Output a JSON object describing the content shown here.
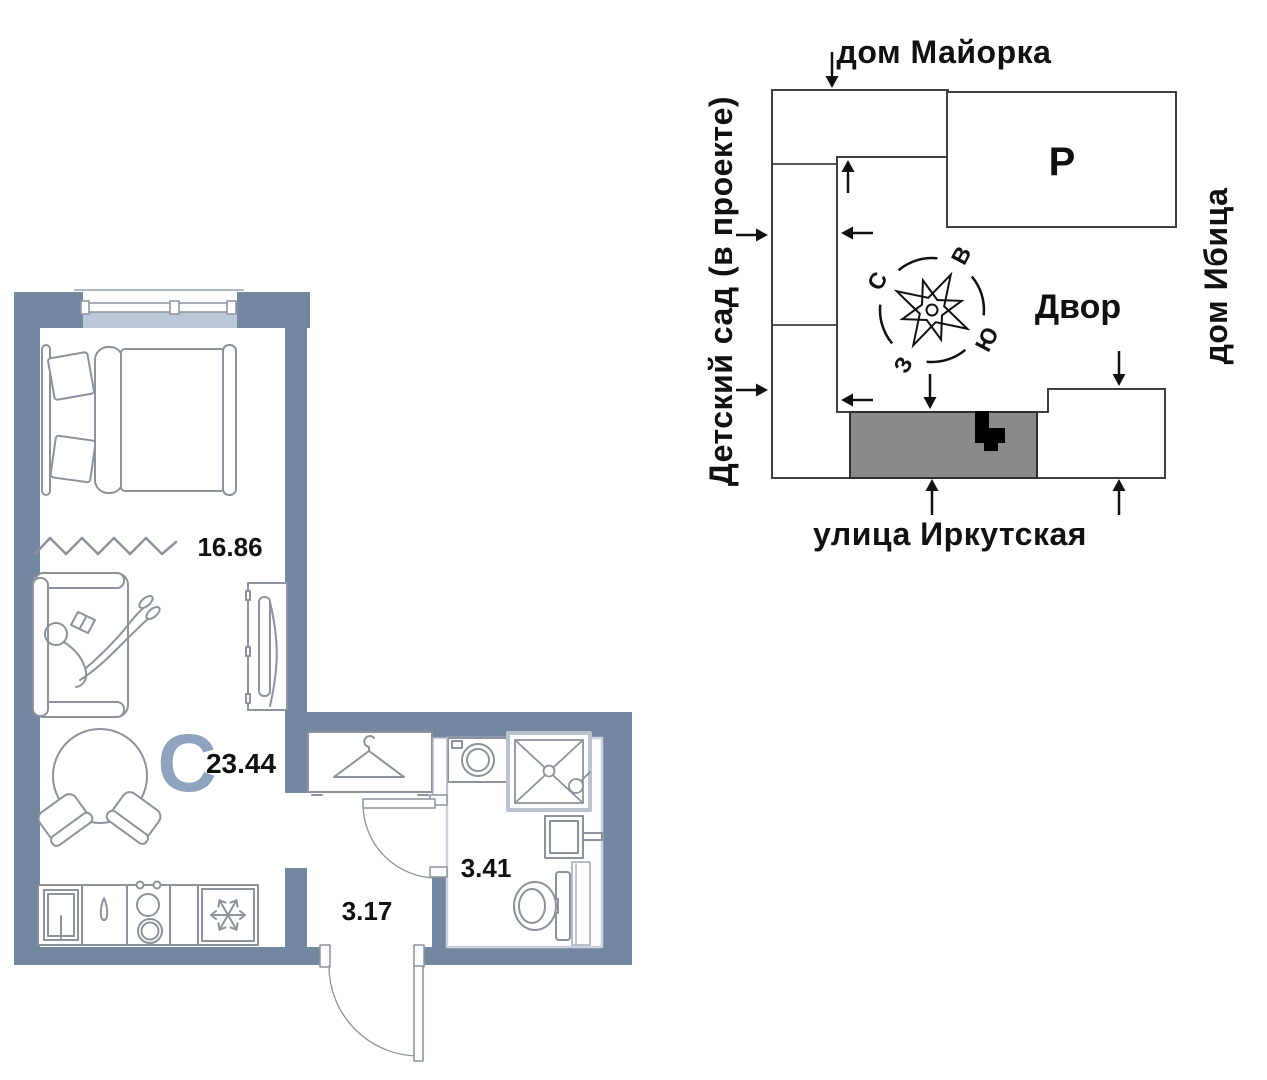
{
  "floor_plan": {
    "studio_letter": "С",
    "total_area": "23.44",
    "room_area": "16.86",
    "hallway_area": "3.17",
    "bathroom_area": "3.41"
  },
  "site_plan": {
    "top_label": "дом Майорка",
    "left_label": "Детский сад (в проекте)",
    "right_label": "дом Ибица",
    "bottom_label": "улица Иркутская",
    "parking_label": "Р",
    "courtyard_label": "Двор",
    "compass": {
      "north": "С",
      "east": "В",
      "south": "Ю",
      "west": "З"
    }
  },
  "colors": {
    "wall": "#7487A1",
    "studio_letter": "#8FA3BE",
    "furniture_line": "#8C939D",
    "light_line": "#AEB7C4",
    "window_sill": "#BCC7D9",
    "site_line": "#3F3F3F",
    "highlight_building": "#8A8A8A",
    "marker": "#000000",
    "text": "#111111"
  }
}
